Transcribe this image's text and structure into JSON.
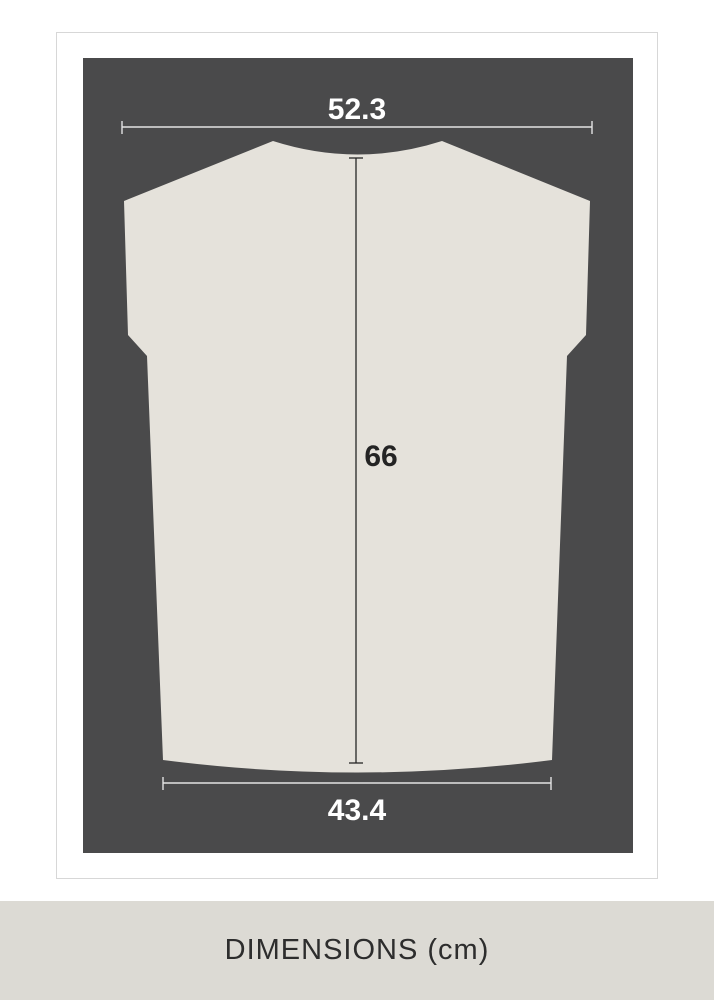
{
  "diagram": {
    "top_width": "52.3",
    "length": "66",
    "bottom_width": "43.4"
  },
  "footer": {
    "label": "DIMENSIONS (cm)"
  },
  "colors": {
    "page_bg": "#ffffff",
    "card_border": "#d7d7d7",
    "panel_bg": "#4a4a4b",
    "shirt_fill": "#e5e2db",
    "light_line": "#e3e3e3",
    "dark_line": "#262626",
    "light_text": "#ffffff",
    "dark_text": "#242424",
    "band_bg": "#dcdad4",
    "band_text": "#2d2d2d"
  }
}
